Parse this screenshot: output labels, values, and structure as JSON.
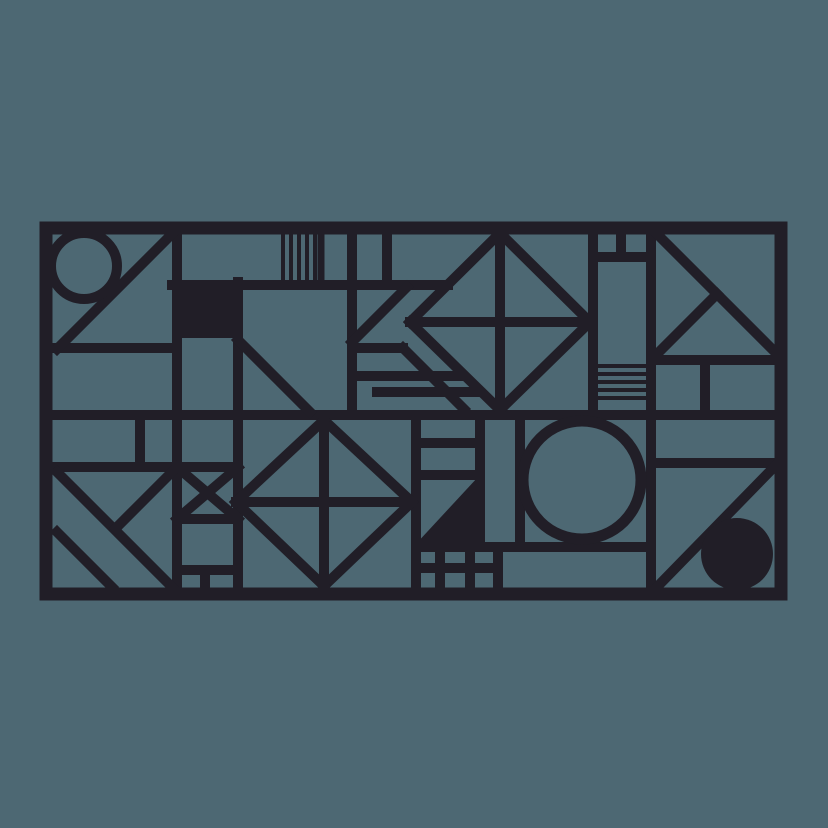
{
  "canvas": {
    "width": 828,
    "height": 828,
    "background_color": "#4d6873",
    "ink_color": "#211e27",
    "description": "abstract-geometric-line-art-panel"
  },
  "frame": {
    "x": 46,
    "y": 228,
    "width": 735,
    "height": 366,
    "stroke_width": 13
  },
  "shapes": {
    "lines": [
      [
        177,
        228,
        177,
        594,
        10
      ],
      [
        46,
        348,
        177,
        348,
        10
      ],
      [
        172,
        234,
        57,
        349,
        10
      ],
      [
        46,
        415,
        778,
        415,
        10
      ],
      [
        46,
        467,
        238,
        467,
        10
      ],
      [
        140,
        415,
        140,
        467,
        10
      ],
      [
        57,
        472,
        172,
        587,
        10
      ],
      [
        172,
        472,
        116,
        528,
        10
      ],
      [
        57,
        532,
        112,
        587,
        10
      ],
      [
        238,
        282,
        238,
        594,
        10
      ],
      [
        172,
        285,
        448,
        285,
        10
      ],
      [
        283,
        228,
        283,
        281,
        4
      ],
      [
        291,
        228,
        291,
        281,
        4
      ],
      [
        299,
        228,
        299,
        281,
        4
      ],
      [
        307,
        228,
        307,
        281,
        4
      ],
      [
        315,
        228,
        315,
        281,
        4
      ],
      [
        321,
        228,
        321,
        281,
        7
      ],
      [
        352,
        228,
        352,
        415,
        10
      ],
      [
        387,
        228,
        387,
        285,
        10
      ],
      [
        407,
        287,
        352,
        342,
        10
      ],
      [
        352,
        348,
        403,
        348,
        10
      ],
      [
        403,
        348,
        464,
        409,
        10
      ],
      [
        352,
        376,
        460,
        376,
        10
      ],
      [
        377,
        392,
        476,
        392,
        10
      ],
      [
        238,
        340,
        310,
        412,
        10
      ],
      [
        500,
        233,
        590,
        322,
        10
      ],
      [
        590,
        322,
        500,
        410,
        10
      ],
      [
        500,
        410,
        410,
        322,
        10
      ],
      [
        410,
        322,
        500,
        233,
        10
      ],
      [
        500,
        228,
        500,
        413,
        10
      ],
      [
        410,
        322,
        593,
        322,
        10
      ],
      [
        593,
        228,
        593,
        415,
        10
      ],
      [
        593,
        257,
        651,
        257,
        10
      ],
      [
        621,
        228,
        621,
        257,
        10
      ],
      [
        596,
        366,
        648,
        366,
        4
      ],
      [
        596,
        374,
        648,
        374,
        4
      ],
      [
        596,
        382,
        648,
        382,
        4
      ],
      [
        596,
        390,
        648,
        390,
        4
      ],
      [
        596,
        398,
        648,
        398,
        4
      ],
      [
        651,
        228,
        651,
        594,
        10
      ],
      [
        651,
        360,
        778,
        360,
        10
      ],
      [
        656,
        233,
        778,
        355,
        10
      ],
      [
        717,
        294,
        656,
        355,
        10
      ],
      [
        705,
        360,
        705,
        415,
        10
      ],
      [
        651,
        463,
        778,
        463,
        10
      ],
      [
        656,
        588,
        778,
        463,
        10
      ],
      [
        416,
        415,
        416,
        594,
        10
      ],
      [
        480,
        415,
        480,
        547,
        10
      ],
      [
        520,
        415,
        520,
        547,
        10
      ],
      [
        416,
        443,
        480,
        443,
        10
      ],
      [
        416,
        475,
        480,
        475,
        10
      ],
      [
        416,
        547,
        651,
        547,
        10
      ],
      [
        440,
        547,
        440,
        594,
        10
      ],
      [
        470,
        547,
        470,
        594,
        10
      ],
      [
        498,
        547,
        498,
        594,
        10
      ],
      [
        416,
        568,
        498,
        568,
        10
      ],
      [
        324,
        420,
        412,
        502,
        10
      ],
      [
        412,
        502,
        324,
        586,
        10
      ],
      [
        324,
        586,
        236,
        502,
        10
      ],
      [
        236,
        502,
        324,
        420,
        10
      ],
      [
        324,
        415,
        324,
        594,
        10
      ],
      [
        236,
        502,
        412,
        502,
        10
      ],
      [
        177,
        467,
        238,
        519,
        10
      ],
      [
        238,
        467,
        177,
        519,
        10
      ],
      [
        177,
        519,
        238,
        519,
        10
      ],
      [
        177,
        570,
        238,
        570,
        10
      ],
      [
        205,
        570,
        205,
        594,
        10
      ]
    ],
    "circles": [
      {
        "cx": 84,
        "cy": 266,
        "r": 33,
        "filled": false,
        "sw": 10
      },
      {
        "cx": 582,
        "cy": 480,
        "r": 59,
        "filled": false,
        "sw": 11
      },
      {
        "cx": 737,
        "cy": 554,
        "r": 36,
        "filled": true,
        "sw": 0
      }
    ],
    "rects": [
      {
        "x": 172,
        "y": 280,
        "w": 71,
        "h": 58
      }
    ],
    "polygons": [
      {
        "points": "478,477 478,545 415,545"
      }
    ]
  }
}
